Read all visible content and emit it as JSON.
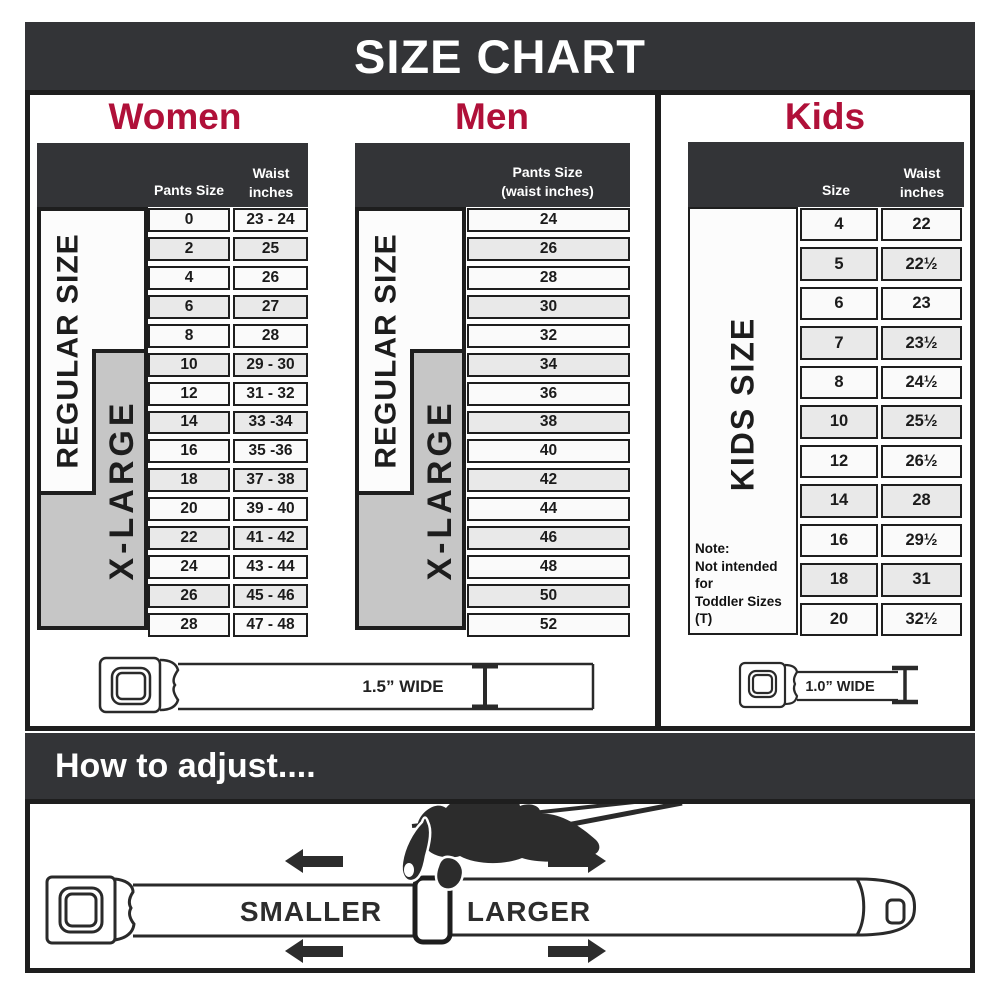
{
  "title": "SIZE CHART",
  "colors": {
    "dark_bar": "#333437",
    "accent_crimson": "#b01039",
    "xlarge_gray": "#c6c6c6",
    "row_alt": "#e9e9e9",
    "border": "#1e1e1e"
  },
  "women": {
    "title": "Women",
    "col1_header": "Pants Size",
    "col2_header": [
      "Waist",
      "inches"
    ],
    "regular_label": "REGULAR SIZE",
    "xlarge_label": "X-LARGE",
    "rows": [
      [
        "0",
        "23 - 24"
      ],
      [
        "2",
        "25"
      ],
      [
        "4",
        "26"
      ],
      [
        "6",
        "27"
      ],
      [
        "8",
        "28"
      ],
      [
        "10",
        "29 - 30"
      ],
      [
        "12",
        "31 - 32"
      ],
      [
        "14",
        "33 -34"
      ],
      [
        "16",
        "35 -36"
      ],
      [
        "18",
        "37 - 38"
      ],
      [
        "20",
        "39 - 40"
      ],
      [
        "22",
        "41 - 42"
      ],
      [
        "24",
        "43 - 44"
      ],
      [
        "26",
        "45 - 46"
      ],
      [
        "28",
        "47 - 48"
      ]
    ]
  },
  "men": {
    "title": "Men",
    "col_header": [
      "Pants Size",
      "(waist inches)"
    ],
    "regular_label": "REGULAR SIZE",
    "xlarge_label": "X-LARGE",
    "rows": [
      "24",
      "26",
      "28",
      "30",
      "32",
      "34",
      "36",
      "38",
      "40",
      "42",
      "44",
      "46",
      "48",
      "50",
      "52"
    ]
  },
  "kids": {
    "title": "Kids",
    "col1_header": "Size",
    "col2_header": [
      "Waist",
      "inches"
    ],
    "side_label": "KIDS SIZE",
    "note": [
      "Note:",
      "Not intended for",
      "Toddler Sizes (T)"
    ],
    "rows": [
      [
        "4",
        "22"
      ],
      [
        "5",
        "22½"
      ],
      [
        "6",
        "23"
      ],
      [
        "7",
        "23½"
      ],
      [
        "8",
        "24½"
      ],
      [
        "10",
        "25½"
      ],
      [
        "12",
        "26½"
      ],
      [
        "14",
        "28"
      ],
      [
        "16",
        "29½"
      ],
      [
        "18",
        "31"
      ],
      [
        "20",
        "32½"
      ]
    ]
  },
  "belts": {
    "adult_label": "1.5” WIDE",
    "kids_label": "1.0” WIDE"
  },
  "adjust": {
    "heading": "How to adjust....",
    "smaller": "SMALLER",
    "larger": "LARGER"
  },
  "chart_data": [
    {
      "type": "table",
      "title": "Women",
      "columns": [
        "Pants Size",
        "Waist inches"
      ],
      "rows": [
        [
          "0",
          "23 - 24"
        ],
        [
          "2",
          "25"
        ],
        [
          "4",
          "26"
        ],
        [
          "6",
          "27"
        ],
        [
          "8",
          "28"
        ],
        [
          "10",
          "29 - 30"
        ],
        [
          "12",
          "31 - 32"
        ],
        [
          "14",
          "33 -34"
        ],
        [
          "16",
          "35 -36"
        ],
        [
          "18",
          "37 - 38"
        ],
        [
          "20",
          "39 - 40"
        ],
        [
          "22",
          "41 - 42"
        ],
        [
          "24",
          "43 - 44"
        ],
        [
          "26",
          "45 - 46"
        ],
        [
          "28",
          "47 - 48"
        ]
      ],
      "annotations": {
        "regular_size_rows": "0-18",
        "x_large_rows": "10-28",
        "belt_width": "1.5\" WIDE"
      }
    },
    {
      "type": "table",
      "title": "Men",
      "columns": [
        "Pants Size (waist inches)"
      ],
      "rows": [
        [
          "24"
        ],
        [
          "26"
        ],
        [
          "28"
        ],
        [
          "30"
        ],
        [
          "32"
        ],
        [
          "34"
        ],
        [
          "36"
        ],
        [
          "38"
        ],
        [
          "40"
        ],
        [
          "42"
        ],
        [
          "44"
        ],
        [
          "46"
        ],
        [
          "48"
        ],
        [
          "50"
        ],
        [
          "52"
        ]
      ],
      "annotations": {
        "regular_size_rows": "24-42",
        "x_large_rows": "34-52",
        "belt_width": "1.5\" WIDE"
      }
    },
    {
      "type": "table",
      "title": "Kids",
      "columns": [
        "Size",
        "Waist inches"
      ],
      "rows": [
        [
          "4",
          "22"
        ],
        [
          "5",
          "22½"
        ],
        [
          "6",
          "23"
        ],
        [
          "7",
          "23½"
        ],
        [
          "8",
          "24½"
        ],
        [
          "10",
          "25½"
        ],
        [
          "12",
          "26½"
        ],
        [
          "14",
          "28"
        ],
        [
          "16",
          "29½"
        ],
        [
          "18",
          "31"
        ],
        [
          "20",
          "32½"
        ]
      ],
      "annotations": {
        "note": "Not intended for Toddler Sizes (T)",
        "belt_width": "1.0\" WIDE"
      }
    }
  ]
}
